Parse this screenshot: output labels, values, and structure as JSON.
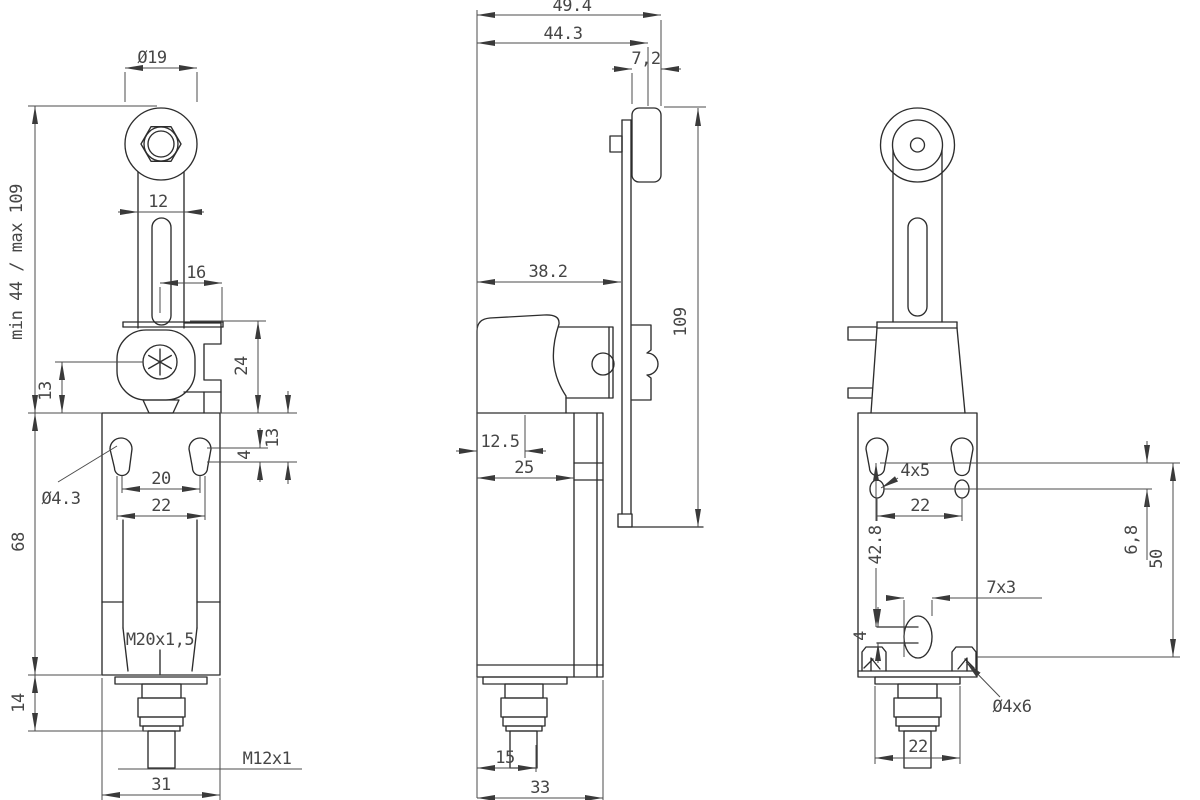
{
  "document": {
    "kind": "technical dimensional drawing, limit switch with adjustable roller lever, three orthographic views",
    "background": "#ffffff",
    "line_color": "#2d2d2d",
    "dim_color": "#4b4b4b"
  },
  "views": {
    "front": {
      "name": "front view",
      "labels": {
        "roller_dia": "Ø19",
        "lever_width": "12",
        "travel": "min 44  /  max 109",
        "arm_offset": "16",
        "head_h": "24",
        "pivot_h": "13",
        "edge_h": "13",
        "slot_w": "4",
        "hole_dia": "Ø4.3",
        "pitch": "20",
        "span": "22",
        "body_h": "68",
        "gland": "M20x1,5",
        "flange_h": "14",
        "conn_thread": "M12x1",
        "body_w": "31"
      }
    },
    "side": {
      "name": "side view",
      "labels": {
        "total_d": "49.4",
        "roller_d": "44.3",
        "disc_t": "7,2",
        "lever_d": "38.2",
        "lever_len": "109",
        "conn_off": "12.5",
        "mech_off": "25",
        "conn_off2": "15",
        "body_d": "33"
      }
    },
    "back": {
      "name": "back view",
      "labels": {
        "slot_size": "4x5",
        "hole_pitch": "22",
        "hole_h": "42.8",
        "slot_off": "6,8",
        "mount_h": "50",
        "oblong": "7x3",
        "oblong_off": "4",
        "clip_hole": "Ø4x6",
        "conn_w": "22"
      }
    }
  }
}
